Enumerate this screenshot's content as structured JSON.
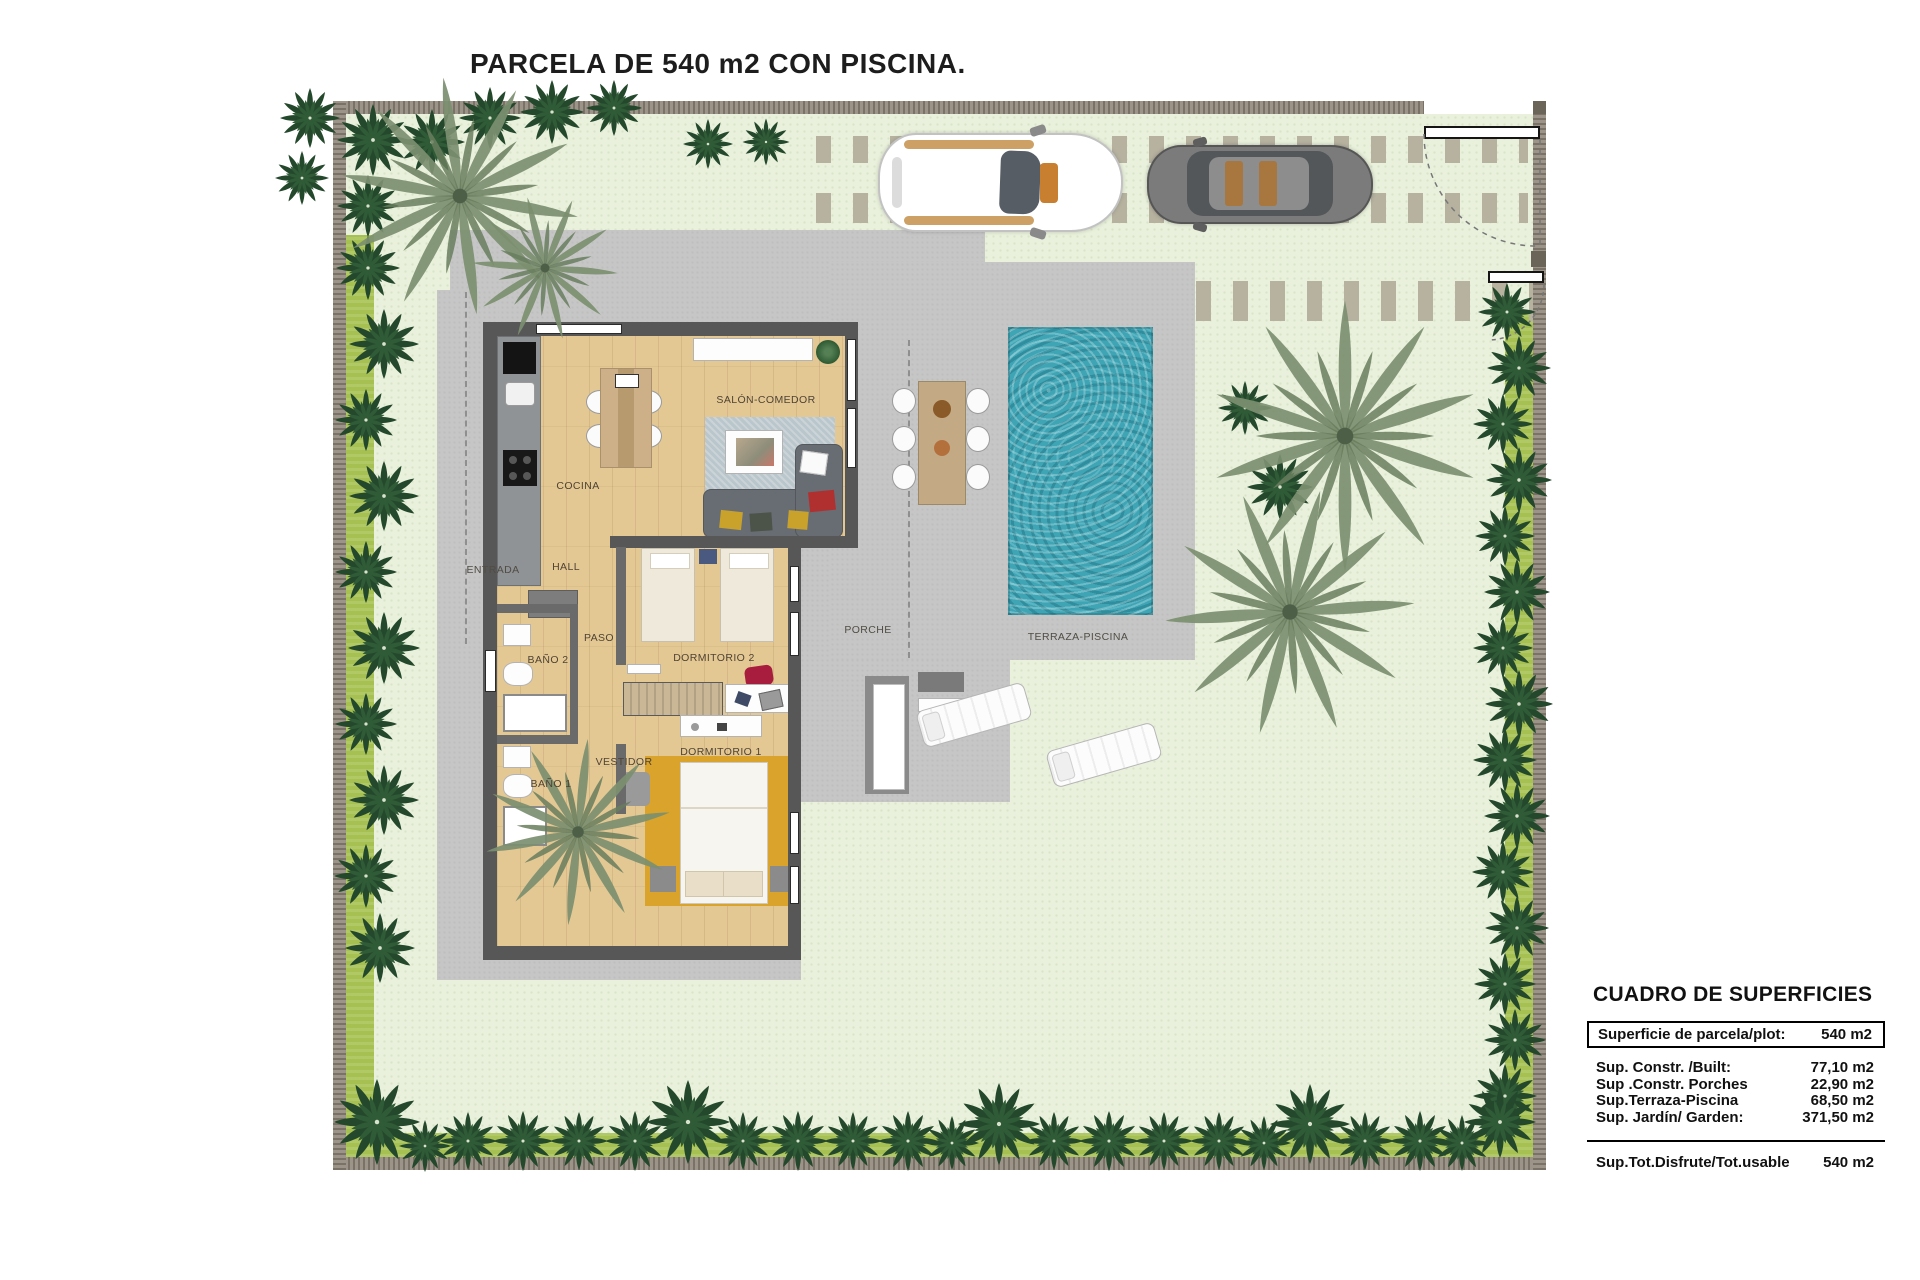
{
  "title": "PARCELA DE 540 m2 CON PISCINA.",
  "rooms": {
    "cocina": "COCINA",
    "salon_comedor": "SALÓN-COMEDOR",
    "entrada": "ENTRADA",
    "hall": "HALL",
    "paso": "PASO",
    "bano2": "BAÑO 2",
    "dormitorio2": "DORMITORIO 2",
    "vestidor": "VESTIDOR",
    "bano1": "BAÑO 1",
    "dormitorio1": "DORMITORIO 1",
    "porche": "PORCHE",
    "terraza_piscina": "TERRAZA-PISCINA"
  },
  "surface_table": {
    "heading": "CUADRO DE SUPERFICIES",
    "plot_row": {
      "label": "Superficie de parcela/plot:",
      "value": "540 m2"
    },
    "rows": [
      {
        "label": "Sup. Constr. /Built:",
        "value": "77,10 m2"
      },
      {
        "label": "Sup .Constr. Porches",
        "value": "22,90 m2"
      },
      {
        "label": "Sup.Terraza-Piscina",
        "value": "68,50 m2"
      },
      {
        "label": "Sup. Jardín/ Garden:",
        "value": "371,50 m2"
      }
    ],
    "total_row": {
      "label": "Sup.Tot.Disfrute/Tot.usable",
      "value": "540 m2"
    }
  },
  "colors": {
    "garden": "#e9f1dc",
    "hedge": "#a6c152",
    "boundary_wall": "#9c9488",
    "paving": "#c6c6c6",
    "pool_water": "#3fa5b5",
    "house_wall": "#575757",
    "wood_floor": "#e4c894",
    "rug_dorm1": "#d9a32c"
  }
}
